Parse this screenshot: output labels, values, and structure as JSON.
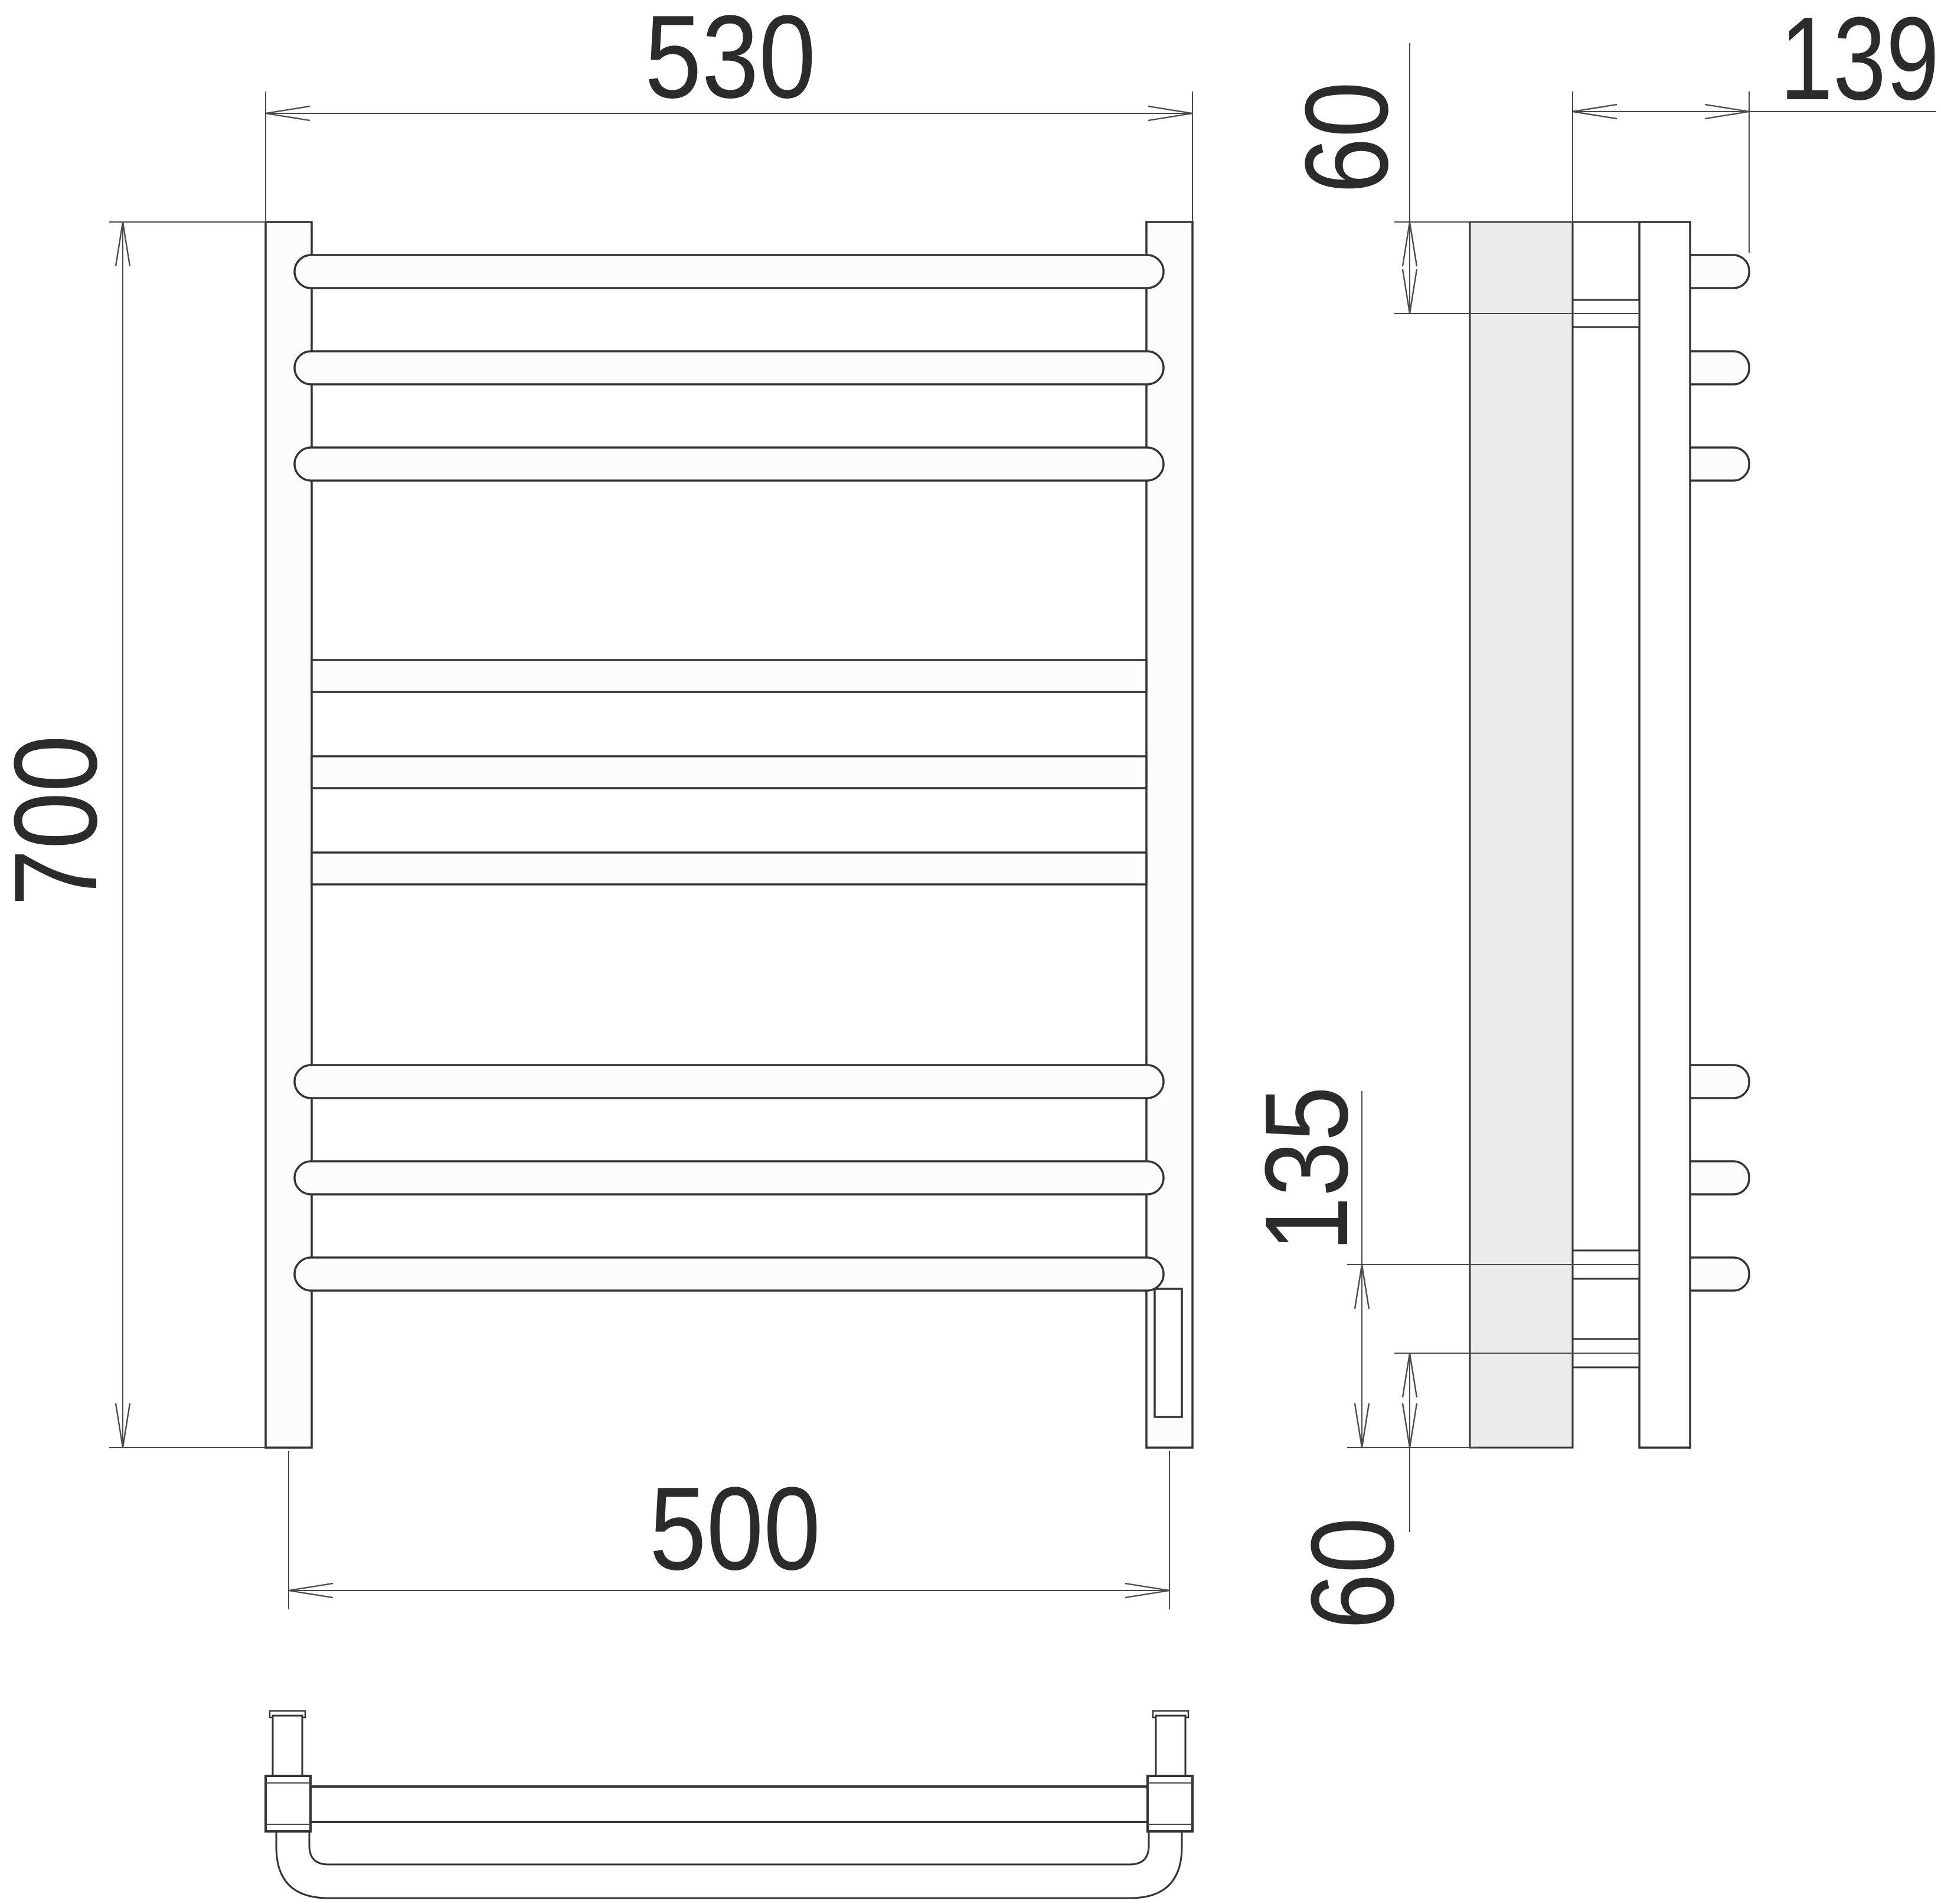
{
  "meta": {
    "kind": "technical-drawing",
    "subject": "wall-mounted ladder towel rail, three orthographic views",
    "units": "mm"
  },
  "colors": {
    "background": "#ffffff",
    "line": "#343434",
    "dimension_line": "#4a4a4a",
    "text": "#2b2b2b",
    "mount_plate_fill": "#ebebeb",
    "tube_fill": "#fcfcfc"
  },
  "views": {
    "front": {
      "bar_count": 9,
      "round_bar_count": 6,
      "flat_bar_count": 3,
      "dims": {
        "overall_width": "530",
        "overall_height": "700",
        "axis_width": "500"
      }
    },
    "side": {
      "stub_count": 6,
      "bracket_count": 3,
      "dims": {
        "depth": "139",
        "top_offset": "60",
        "lower_span": "135",
        "bottom_offset": "60"
      }
    },
    "bottom": {
      "description": "top-down view of lower rail and U-tube"
    }
  }
}
